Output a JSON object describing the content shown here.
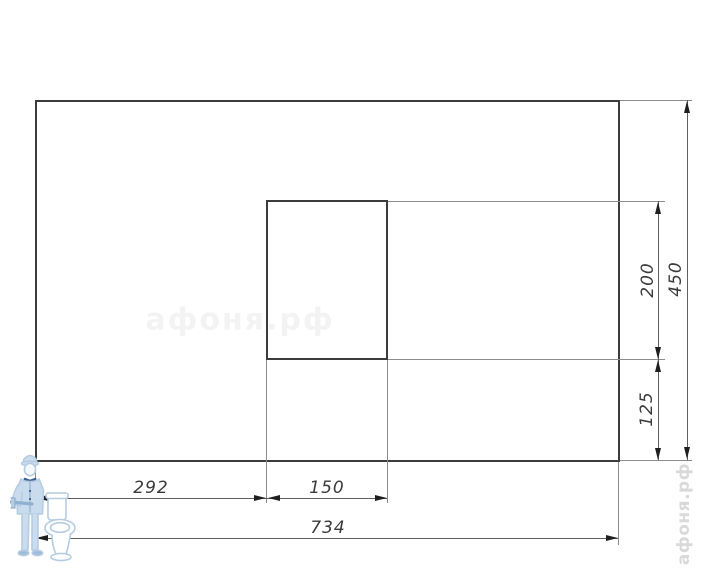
{
  "page": {
    "background": "#ffffff"
  },
  "drawing": {
    "type": "technical-dimension-drawing",
    "labels": {
      "dim_292": "292",
      "dim_150": "150",
      "dim_734": "734",
      "dim_200": "200",
      "dim_450": "450",
      "dim_125": "125"
    },
    "dimensions_units": {
      "total_width": 734,
      "total_height": 450,
      "left_offset_to_cutout": 292,
      "cutout_width": 150,
      "cutout_height": 200,
      "cutout_bottom_offset": 125
    },
    "colors": {
      "outline": "#3c3c3c",
      "dimension_line": "#5f5f5f",
      "extension_line": "#8c8c8c",
      "arrow": "#1f1f1f",
      "label_text": "#3a3a3a",
      "watermark_center": "#f3f3f3",
      "watermark_side": "#d9d9d9",
      "mascot_blue": "#b5cce2"
    },
    "watermarks": {
      "center_text": "афоня.рф",
      "side_text": "афоня.рф"
    }
  }
}
